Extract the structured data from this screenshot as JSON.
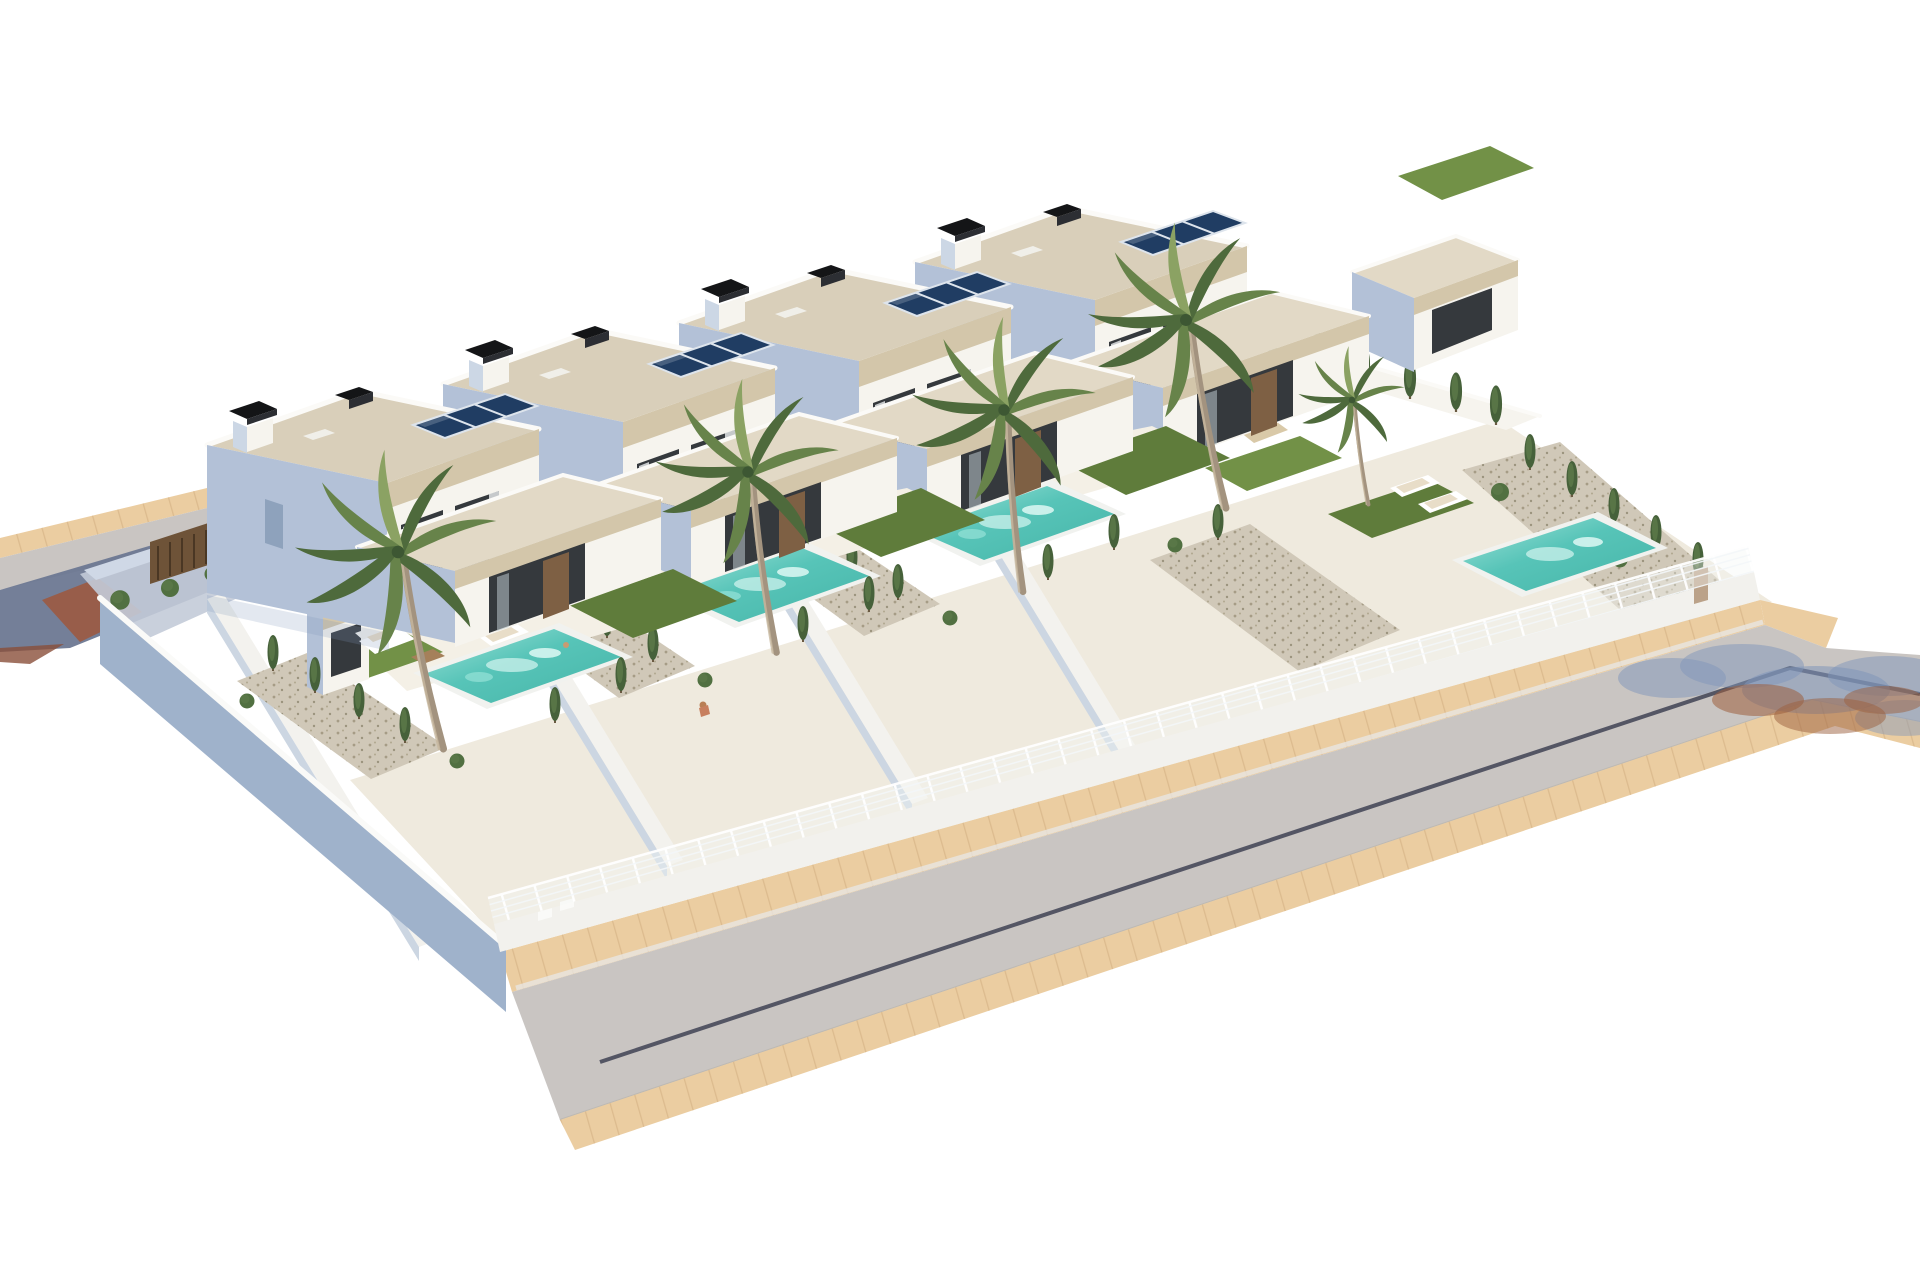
{
  "meta": {
    "description": "Aerial 3D architectural rendering of four staggered modern two-storey villas, each with a private turquoise pool, artificial lawn, terrace furniture, cypress hedges, white wire fences on low walls and tall palm trees; asphalt road with sand-coloured sidewalks runs along the front with a bend to the right; white empty background.",
    "style": "photorealistic CGI, high-key lighting, isometric aerial view"
  },
  "scene": {
    "villa_count": 4,
    "pool_count": 4,
    "palm_count": 5,
    "villas": [
      {
        "id": "villa-1",
        "floors": 2,
        "solar_panels": 3,
        "chimneys": 2,
        "pool": true,
        "lawn": true,
        "palm": true
      },
      {
        "id": "villa-2",
        "floors": 2,
        "solar_panels": 3,
        "chimneys": 2,
        "pool": true,
        "lawn": true,
        "palm": true
      },
      {
        "id": "villa-3",
        "floors": 2,
        "solar_panels": 3,
        "chimneys": 2,
        "pool": true,
        "lawn": true,
        "palm": true
      },
      {
        "id": "villa-4",
        "floors": 2,
        "solar_panels": 3,
        "chimneys": 2,
        "pool": true,
        "lawn": true,
        "palm": true
      }
    ],
    "streets": {
      "front_road": {
        "surface": "asphalt",
        "lane_joint_line": true,
        "sidewalks": "sand pavers",
        "bend_to_right": true,
        "tree_shadow_on_road": true
      },
      "back_road_top_left": {
        "partial": true,
        "sidewalk": "sand pavers",
        "driveway": "dark pavers with red-brown tiles"
      }
    },
    "enclosure": {
      "front_fence": "white wire mesh on low white wall",
      "left_boundary": "tall white wall in blue shadow",
      "right_boundary": "white wall with cypress row"
    },
    "vegetation": {
      "palms": 5,
      "cypress_hedges": true,
      "shrubs": true,
      "gravel_beds": true
    }
  },
  "palette": {
    "bg": "#ffffff",
    "roof": "#d9cfba",
    "roofLight": "#e2d9c6",
    "band": "#d3c6aa",
    "wallSun": "#f6f4ee",
    "wallSunDim": "#eceade",
    "wallShade": "#b3c1d7",
    "wallShadeDeep": "#9fb2cb",
    "parapet": "#fbfaf7",
    "glass": "#35393d",
    "door": "#7e6044",
    "solar": "#203d63",
    "solarLine": "#dde4ec",
    "chimney": "#141517",
    "poolRim": "#f1f2ef",
    "poolWater": "#57c4b8",
    "poolWaterLight": "#9fe3d9",
    "lawn": "#5f7c3b",
    "lawnLight": "#729147",
    "terrace": "#efeade",
    "terraceLight": "#f4f0e6",
    "gravel": "#d0c8b8",
    "road": "#c9c5c2",
    "roadLine": "#3f4254",
    "sidewalk": "#ebcda1",
    "sidewalkLine": "#d8b78a",
    "fencePost": "#ffffff",
    "fenceWire": "#f4f8fa",
    "cypress": "#46613a",
    "cypressLight": "#5d7a4a",
    "shrub": "#517041",
    "palmDark": "#4e6a3c",
    "palmMid": "#67834a",
    "palmLight": "#8ba263",
    "trunk": "#a3937f",
    "slatWood": "#6e5338",
    "shadowBlue": "#8096ba",
    "shadowBrown": "#9c5f3e",
    "driveDark": "#6d7892",
    "driveRed": "#9c5a41"
  }
}
